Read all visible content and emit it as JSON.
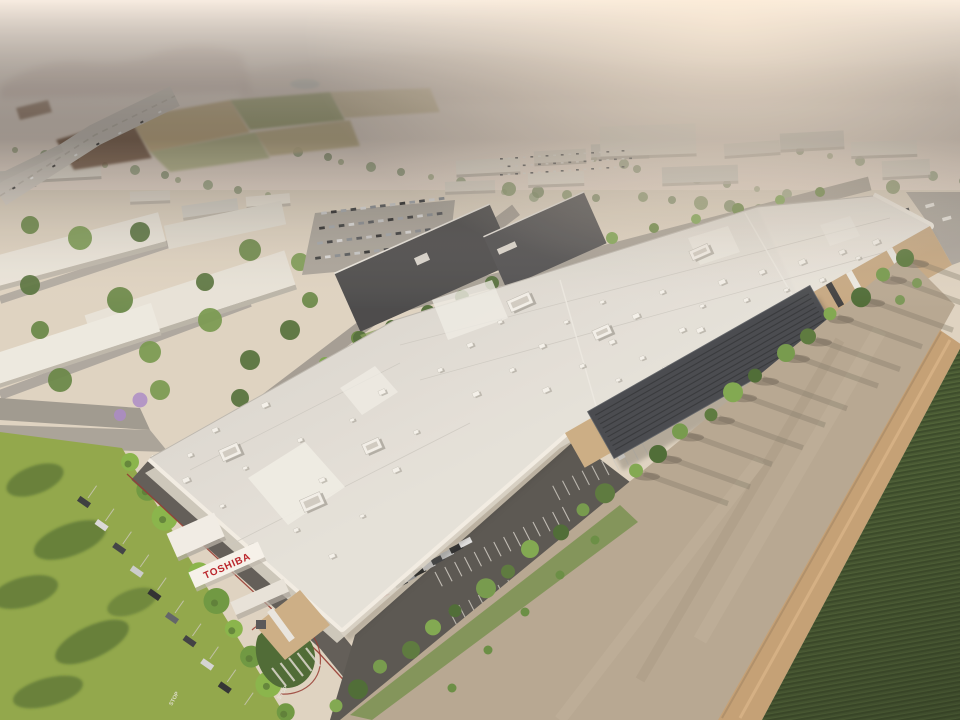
{
  "scene_signs": {
    "building_roof_sign": "TOSHIBA",
    "trailer_logo": "FedEx",
    "pavement_marking_a": "STOP",
    "pavement_marking_b": "STOP"
  },
  "palette": {
    "brand_red": "#b5121b",
    "haze_sky": "#f7efe7",
    "roof_gray": "#dad7d0",
    "asphalt": "#4c4a46",
    "lawn_green": "#85a23c",
    "crop_green": "#3a5023",
    "dirt_tan": "#b2a28c",
    "solar_dark": "#383c42"
  }
}
